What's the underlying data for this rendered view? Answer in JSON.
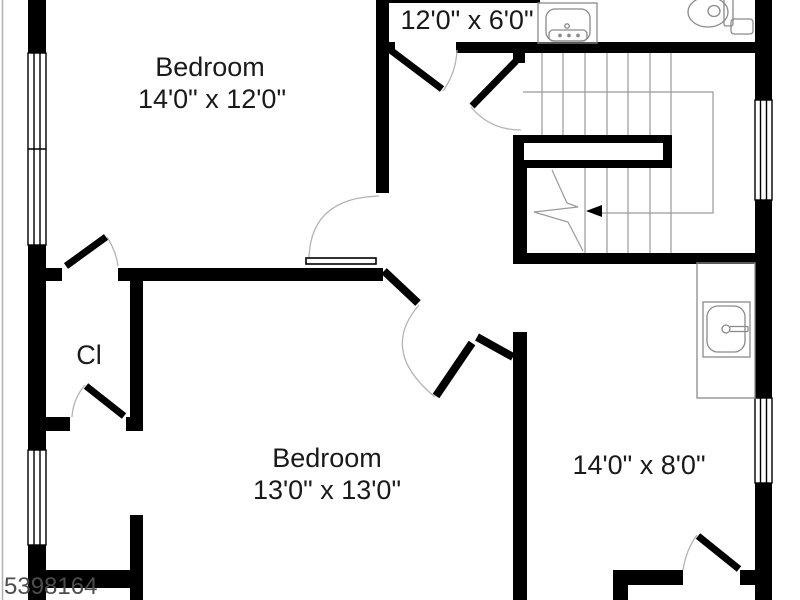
{
  "plan": {
    "type": "floor-plan",
    "watermark": "5398164",
    "rooms": {
      "bedroom_top": {
        "name": "Bedroom",
        "dims": "14'0\" x 12'0\""
      },
      "bath_top": {
        "dims": "12'0\" x 6'0\""
      },
      "closet": {
        "label": "Cl"
      },
      "bedroom_bottom": {
        "name": "Bedroom",
        "dims": "13'0\" x 13'0\""
      },
      "room_right": {
        "dims": "14'0\" x 8'0\""
      }
    },
    "fixtures": [
      "vanity-sink",
      "toilet",
      "utility-sink",
      "staircase"
    ],
    "colors": {
      "wall": "#000000",
      "fixture_line": "#8a8a8a",
      "arc_line": "#b3b3b3",
      "tread_line": "#9a9a9a",
      "text": "#1a1a1a",
      "watermark": "#4d4d4d"
    }
  }
}
